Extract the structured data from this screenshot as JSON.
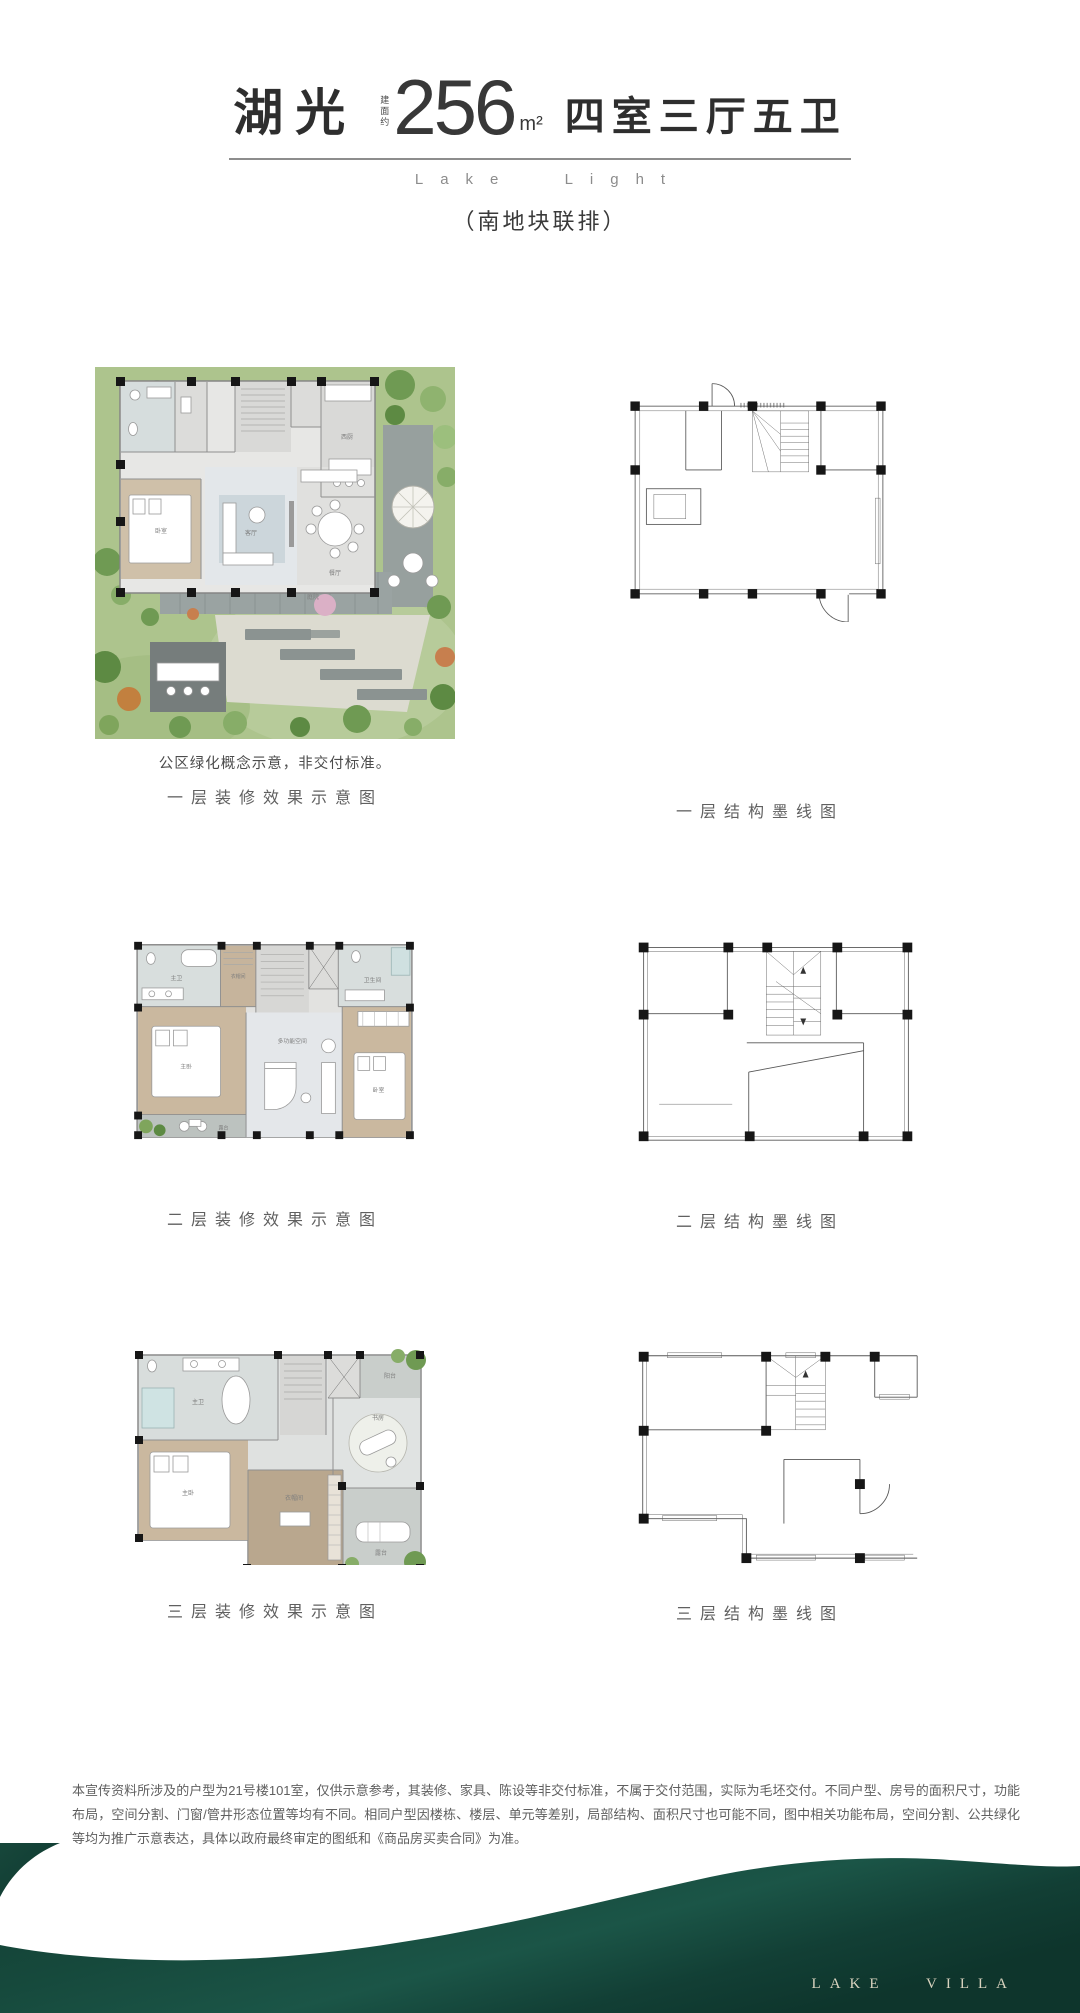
{
  "header": {
    "title": "湖光",
    "area_label": "建面约",
    "area_value": "256",
    "area_unit": "m²",
    "spec": "四室三厅五卫",
    "subtitle_en": "Lake Light",
    "tagline": "（南地块联排）"
  },
  "sections": [
    {
      "note": "公区绿化概念示意，非交付标准。",
      "left_caption": "一层装修效果示意图",
      "right_caption": "一层结构墨线图"
    },
    {
      "left_caption": "二层装修效果示意图",
      "right_caption": "二层结构墨线图"
    },
    {
      "left_caption": "三层装修效果示意图",
      "right_caption": "三层结构墨线图"
    }
  ],
  "plans": {
    "floor1": {
      "rooms": {
        "bedroom": "卧室",
        "living": "客厅",
        "dining": "餐厅",
        "kitchen": "西厨",
        "garden": "庭院"
      }
    },
    "floor2": {
      "rooms": {
        "master_bath": "主卫",
        "cloakroom": "衣帽间",
        "bath": "卫生间",
        "master_bedroom": "主卧",
        "multi": "多功能空间",
        "bedroom": "卧室",
        "terrace": "露台"
      }
    },
    "floor3": {
      "rooms": {
        "master_bath": "主卫",
        "study": "书房",
        "master_bedroom": "主卧",
        "cloakroom": "衣帽间",
        "terrace": "露台",
        "balcony": "阳台"
      }
    }
  },
  "disclaimer": "本宣传资料所涉及的户型为21号楼101室，仅供示意参考，其装修、家具、陈设等非交付标准，不属于交付范围，实际为毛坯交付。不同户型、房号的面积尺寸，功能布局，空间分割、门窗/管井形态位置等均有不同。相同户型因楼栋、楼层、单元等差别，局部结构、面积尺寸也可能不同，图中相关功能布局，空间分割、公共绿化等均为推广示意表达，具体以政府最终审定的图纸和《商品房买卖合同》为准。",
  "footer": {
    "brand": "LAKE VILLA"
  },
  "colors": {
    "footer_green_dark": "#0e352c",
    "footer_green": "#16493c",
    "footer_green_light": "#1d5748"
  }
}
